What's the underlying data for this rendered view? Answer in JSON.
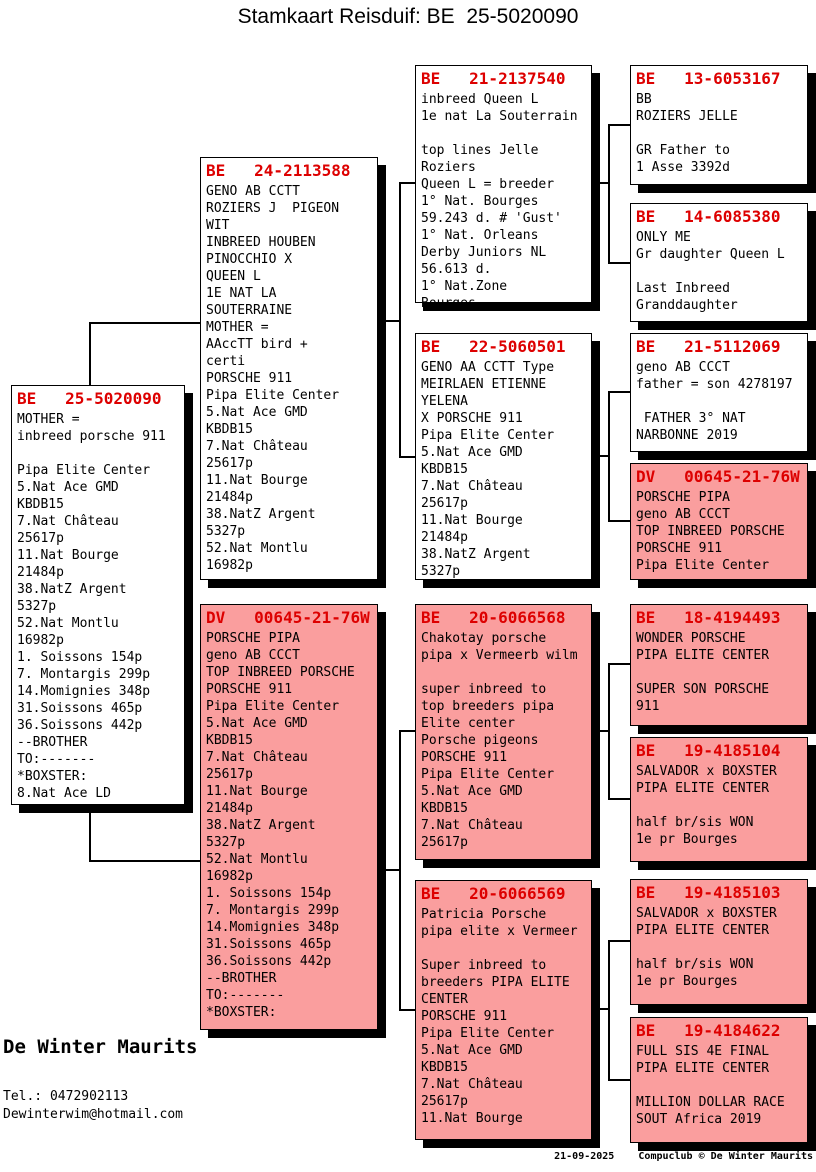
{
  "title": "Stamkaart Reisduif: BE  25-5020090",
  "colors": {
    "box_pink": "#FA9E9E",
    "ring_red": "#DD0000",
    "line_black": "#000000"
  },
  "breeder": {
    "name": "De Winter Maurits",
    "tel": "Tel.: 0472902113",
    "email": "Dewinterwim@hotmail.com"
  },
  "footer": "21-09-2025    Compuclub © De Winter Maurits",
  "boxes": {
    "subject": {
      "ring": "BE   25-5020090",
      "text": "MOTHER =\ninbreed porsche 911\n\nPipa Elite Center\n5.Nat Ace GMD\nKBDB15\n7.Nat Château\n25617p\n11.Nat Bourge\n21484p\n38.NatZ Argent\n5327p\n52.Nat Montlu\n16982p\n1. Soissons 154p\n7. Montargis 299p\n14.Momignies 348p\n31.Soissons 465p\n36.Soissons 442p\n--BROTHER\nTO:-------\n*BOXSTER:\n8.Nat Ace LD"
    },
    "father": {
      "ring": "BE   24-2113588",
      "text": "GENO AB CCTT\nROZIERS J  PIGEON\nWIT\nINBREED HOUBEN\nPINOCCHIO X\nQUEEN L\n1E NAT LA\nSOUTERRAINE\nMOTHER =\nAAccTT bird +\ncerti\nPORSCHE 911\nPipa Elite Center\n5.Nat Ace GMD\nKBDB15\n7.Nat Château\n25617p\n11.Nat Bourge\n21484p\n38.NatZ Argent\n5327p\n52.Nat Montlu\n16982p"
    },
    "mother": {
      "ring": "DV   00645-21-76W",
      "text": "PORSCHE PIPA\ngeno AB CCCT\nTOP INBREED PORSCHE\nPORSCHE 911\nPipa Elite Center\n5.Nat Ace GMD\nKBDB15\n7.Nat Château\n25617p\n11.Nat Bourge\n21484p\n38.NatZ Argent\n5327p\n52.Nat Montlu\n16982p\n1. Soissons 154p\n7. Montargis 299p\n14.Momignies 348p\n31.Soissons 465p\n36.Soissons 442p\n--BROTHER\nTO:-------\n*BOXSTER:"
    },
    "ff": {
      "ring": "BE   21-2137540",
      "text": "inbreed Queen L\n1e nat La Souterrain\n\ntop lines Jelle\nRoziers\nQueen L = breeder\n1° Nat. Bourges\n59.243 d. # 'Gust'\n1° Nat. Orleans\nDerby Juniors NL\n56.613 d.\n1° Nat.Zone\nBourges."
    },
    "fm": {
      "ring": "BE   22-5060501",
      "text": "GENO AA CCTT Type\nMEIRLAEN ETIENNE\nYELENA\nX PORSCHE 911\nPipa Elite Center\n5.Nat Ace GMD\nKBDB15\n7.Nat Château\n25617p\n11.Nat Bourge\n21484p\n38.NatZ Argent\n5327p"
    },
    "mf": {
      "ring": "BE   20-6066568",
      "text": "Chakotay porsche\npipa x Vermeerb wilm\n\nsuper inbreed to\ntop breeders pipa\nElite center\nPorsche pigeons\nPORSCHE 911\nPipa Elite Center\n5.Nat Ace GMD\nKBDB15\n7.Nat Château\n25617p"
    },
    "mm": {
      "ring": "BE   20-6066569",
      "text": "Patricia Porsche\npipa elite x Vermeer\n\nSuper inbreed to\nbreeders PIPA ELITE\nCENTER\nPORSCHE 911\nPipa Elite Center\n5.Nat Ace GMD\nKBDB15\n7.Nat Château\n25617p\n11.Nat Bourge"
    },
    "fff": {
      "ring": "BE   13-6053167",
      "text": "BB\nROZIERS JELLE\n\nGR Father to\n1 Asse 3392d"
    },
    "ffm": {
      "ring": "BE   14-6085380",
      "text": "ONLY ME\nGr daughter Queen L\n\nLast Inbreed\nGranddaughter"
    },
    "fmf": {
      "ring": "BE   21-5112069",
      "text": "geno AB CCCT\nfather = son 4278197\n\n FATHER 3° NAT\nNARBONNE 2019"
    },
    "fmm": {
      "ring": "DV   00645-21-76W",
      "text": "PORSCHE PIPA\ngeno AB CCCT\nTOP INBREED PORSCHE\nPORSCHE 911\nPipa Elite Center"
    },
    "mff": {
      "ring": "BE   18-4194493",
      "text": "WONDER PORSCHE\nPIPA ELITE CENTER\n\nSUPER SON PORSCHE\n911"
    },
    "mfm": {
      "ring": "BE   19-4185104",
      "text": "SALVADOR x BOXSTER\nPIPA ELITE CENTER\n\nhalf br/sis WON\n1e pr Bourges"
    },
    "mmf": {
      "ring": "BE   19-4185103",
      "text": "SALVADOR x BOXSTER\nPIPA ELITE CENTER\n\nhalf br/sis WON\n1e pr Bourges"
    },
    "mmm": {
      "ring": "BE   19-4184622",
      "text": "FULL SIS 4E FINAL\nPIPA ELITE CENTER\n\nMILLION DOLLAR RACE\nSOUT Africa 2019"
    }
  }
}
